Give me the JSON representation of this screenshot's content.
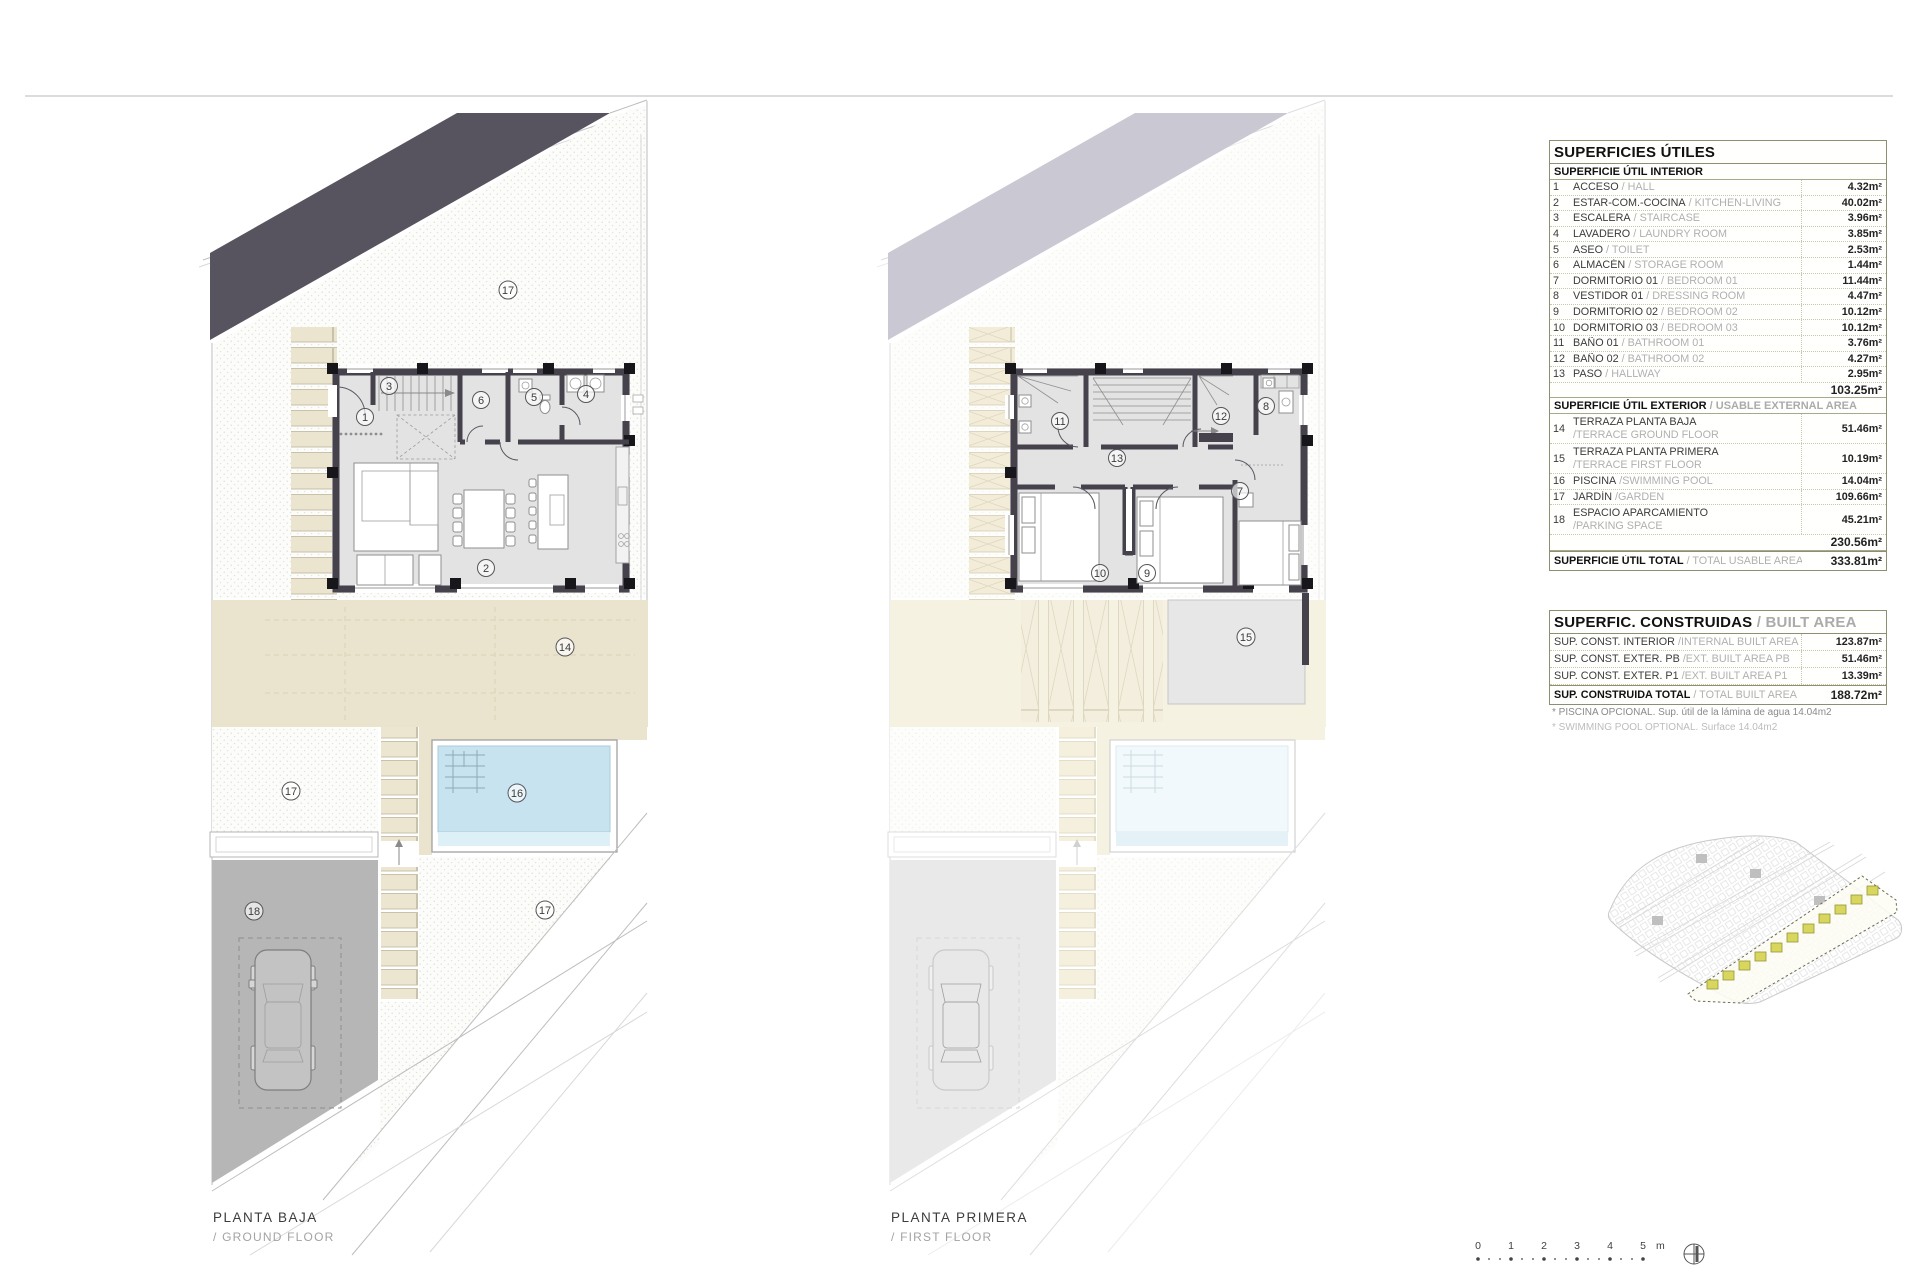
{
  "sheet": {
    "plans": {
      "ground": {
        "title": "PLANTA BAJA",
        "subtitle": "/ GROUND FLOOR",
        "rooms": {
          "acceso": "1",
          "living": "2",
          "stairs": "3",
          "laundry": "4",
          "toilet": "5",
          "storage": "6"
        },
        "areas": {
          "terrace": "14",
          "pool": "16",
          "garden_top": "17",
          "garden_left": "17",
          "garden_right": "17",
          "parking": "18"
        }
      },
      "first": {
        "title": "PLANTA PRIMERA",
        "subtitle": "/ FIRST FLOOR",
        "rooms": {
          "bedroom1": "7",
          "dressing": "8",
          "bedroom2": "9",
          "bedroom3": "10",
          "bath1": "11",
          "bath2": "12",
          "hallway": "13"
        },
        "areas": {
          "terrace": "15"
        }
      }
    },
    "usable_table": {
      "title": "SUPERFICIES ÚTILES",
      "interior_header": "SUPERFICIE ÚTIL INTERIOR",
      "interior_rows": [
        {
          "num": "1",
          "es": "ACCESO",
          "en": "/ HALL",
          "value": "4.32m²"
        },
        {
          "num": "2",
          "es": "ESTAR-COM.-COCINA",
          "en": "/ KITCHEN-LIVING",
          "value": "40.02m²"
        },
        {
          "num": "3",
          "es": "ESCALERA",
          "en": "/ STAIRCASE",
          "value": "3.96m²"
        },
        {
          "num": "4",
          "es": "LAVADERO",
          "en": "/ LAUNDRY ROOM",
          "value": "3.85m²"
        },
        {
          "num": "5",
          "es": "ASEO",
          "en": "/ TOILET",
          "value": "2.53m²"
        },
        {
          "num": "6",
          "es": "ALMACÉN",
          "en": "/ STORAGE ROOM",
          "value": "1.44m²"
        },
        {
          "num": "7",
          "es": "DORMITORIO 01",
          "en": "/ BEDROOM 01",
          "value": "11.44m²"
        },
        {
          "num": "8",
          "es": "VESTIDOR 01",
          "en": "/ DRESSING ROOM",
          "value": "4.47m²"
        },
        {
          "num": "9",
          "es": "DORMITORIO 02",
          "en": "/ BEDROOM 02",
          "value": "10.12m²"
        },
        {
          "num": "10",
          "es": "DORMITORIO 03",
          "en": "/ BEDROOM 03",
          "value": "10.12m²"
        },
        {
          "num": "11",
          "es": "BAÑO 01",
          "en": "/ BATHROOM 01",
          "value": "3.76m²"
        },
        {
          "num": "12",
          "es": "BAÑO 02",
          "en": "/ BATHROOM 02",
          "value": "4.27m²"
        },
        {
          "num": "13",
          "es": "PASO",
          "en": "/ HALLWAY",
          "value": "2.95m²"
        }
      ],
      "interior_subtotal": "103.25m²",
      "exterior_header_es": "SUPERFICIE ÚTIL EXTERIOR",
      "exterior_header_en": "/ USABLE EXTERNAL AREA",
      "exterior_rows": [
        {
          "num": "14",
          "es": "TERRAZA PLANTA BAJA",
          "en": "/TERRACE GROUND FLOOR",
          "value": "51.46m²"
        },
        {
          "num": "15",
          "es": "TERRAZA PLANTA PRIMERA",
          "en": "/TERRACE FIRST FLOOR",
          "value": "10.19m²"
        },
        {
          "num": "16",
          "es": "PISCINA",
          "en": "/SWIMMING POOL",
          "value": "14.04m²"
        },
        {
          "num": "17",
          "es": "JARDÍN",
          "en": "/GARDEN",
          "value": "109.66m²"
        },
        {
          "num": "18",
          "es": "ESPACIO APARCAMIENTO",
          "en": "/PARKING SPACE",
          "value": "45.21m²"
        }
      ],
      "exterior_subtotal": "230.56m²",
      "total_es": "SUPERFICIE ÚTIL TOTAL",
      "total_en": "/ TOTAL USABLE AREA",
      "total_value": "333.81m²"
    },
    "built_table": {
      "title_es": "SUPERFIC. CONSTRUIDAS",
      "title_en": "/ BUILT AREA",
      "rows": [
        {
          "es": "SUP. CONST. INTERIOR",
          "en": "/INTERNAL BUILT AREA",
          "value": "123.87m²"
        },
        {
          "es": "SUP. CONST. EXTER. PB",
          "en": "/EXT. BUILT AREA PB",
          "value": "51.46m²"
        },
        {
          "es": "SUP. CONST. EXTER. P1",
          "en": "/EXT. BUILT AREA P1",
          "value": "13.39m²"
        }
      ],
      "total_es": "SUP. CONSTRUIDA TOTAL",
      "total_en": "/ TOTAL BUILT AREA",
      "total_value": "188.72m²"
    },
    "footnotes": {
      "es": "* PISCINA OPCIONAL. Sup. útil de la lámina de agua 14.04m2",
      "en": "* SWIMMING POOL OPTIONAL. Surface 14.04m2"
    },
    "scale_bar": {
      "ticks": [
        "0",
        "1",
        "2",
        "3",
        "4",
        "5"
      ],
      "unit": "m"
    },
    "colors": {
      "roof_band": "#57535f",
      "terrace": "#eae4ce",
      "pool": "#c6e3ef",
      "parking": "#b6b6b6",
      "highlight_units": "#d8d65c"
    }
  }
}
